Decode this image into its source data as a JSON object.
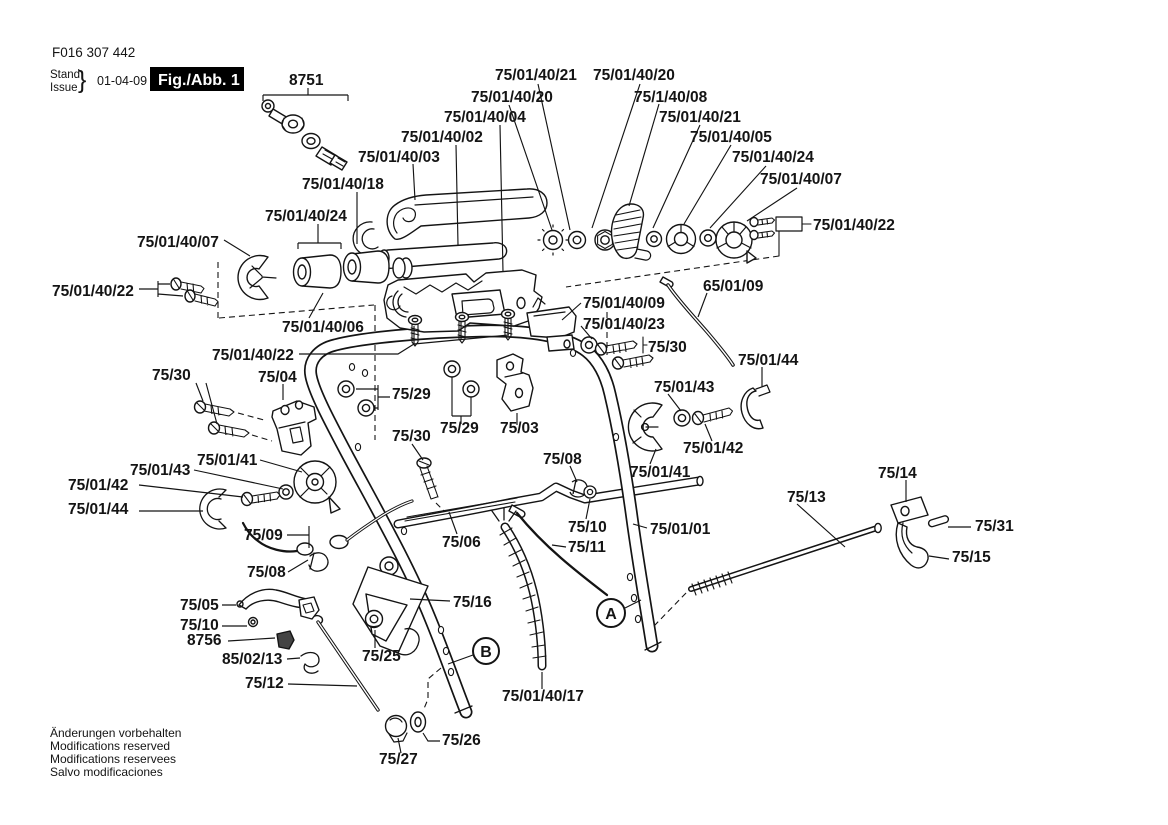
{
  "page": {
    "background": "#ffffff",
    "ink": "#141414"
  },
  "header": {
    "doc_number": "F016 307 442",
    "stand_label": "Stand",
    "issue_label": "Issue",
    "brace": "}",
    "date": "01-04-09",
    "figure_label": "Fig./Abb. 1"
  },
  "callouts": {
    "a": "A",
    "b": "B"
  },
  "footer": {
    "lines": [
      "Änderungen vorbehalten",
      "Modifications reserved",
      "Modifications reservees",
      "Salvo modificaciones"
    ]
  },
  "part_labels": [
    {
      "text": "8751",
      "x": 289,
      "y": 85
    },
    {
      "text": "75/01/40/21",
      "x": 495,
      "y": 80
    },
    {
      "text": "75/01/40/20",
      "x": 593,
      "y": 80
    },
    {
      "text": "75/01/40/20",
      "x": 471,
      "y": 102
    },
    {
      "text": "75/1/40/08",
      "x": 634,
      "y": 102
    },
    {
      "text": "75/01/40/04",
      "x": 444,
      "y": 122
    },
    {
      "text": "75/01/40/21",
      "x": 659,
      "y": 122
    },
    {
      "text": "75/01/40/02",
      "x": 401,
      "y": 142
    },
    {
      "text": "75/01/40/05",
      "x": 690,
      "y": 142
    },
    {
      "text": "75/01/40/03",
      "x": 358,
      "y": 162
    },
    {
      "text": "75/01/40/24",
      "x": 732,
      "y": 162
    },
    {
      "text": "75/01/40/18",
      "x": 302,
      "y": 189
    },
    {
      "text": "75/01/40/07",
      "x": 760,
      "y": 184
    },
    {
      "text": "75/01/40/24",
      "x": 265,
      "y": 221
    },
    {
      "text": "75/01/40/22",
      "x": 813,
      "y": 230
    },
    {
      "text": "75/01/40/07",
      "x": 137,
      "y": 247
    },
    {
      "text": "75/01/40/22",
      "x": 52,
      "y": 296
    },
    {
      "text": "75/01/40/06",
      "x": 282,
      "y": 332
    },
    {
      "text": "75/01/40/22",
      "x": 212,
      "y": 360
    },
    {
      "text": "75/01/40/09",
      "x": 583,
      "y": 308
    },
    {
      "text": "75/01/40/23",
      "x": 583,
      "y": 329
    },
    {
      "text": "65/01/09",
      "x": 703,
      "y": 291
    },
    {
      "text": "75/30",
      "x": 648,
      "y": 352
    },
    {
      "text": "75/01/44",
      "x": 738,
      "y": 365
    },
    {
      "text": "75/30",
      "x": 152,
      "y": 380
    },
    {
      "text": "75/04",
      "x": 258,
      "y": 382
    },
    {
      "text": "75/29",
      "x": 392,
      "y": 399
    },
    {
      "text": "75/01/43",
      "x": 654,
      "y": 392
    },
    {
      "text": "75/29",
      "x": 440,
      "y": 433
    },
    {
      "text": "75/03",
      "x": 500,
      "y": 433
    },
    {
      "text": "75/30",
      "x": 392,
      "y": 441
    },
    {
      "text": "75/01/41",
      "x": 630,
      "y": 477
    },
    {
      "text": "75/01/41",
      "x": 197,
      "y": 465
    },
    {
      "text": "75/01/43",
      "x": 130,
      "y": 475
    },
    {
      "text": "75/01/42",
      "x": 68,
      "y": 490
    },
    {
      "text": "75/01/42",
      "x": 683,
      "y": 453
    },
    {
      "text": "75/01/44",
      "x": 68,
      "y": 514
    },
    {
      "text": "75/08",
      "x": 543,
      "y": 464
    },
    {
      "text": "75/14",
      "x": 878,
      "y": 478
    },
    {
      "text": "75/13",
      "x": 787,
      "y": 502
    },
    {
      "text": "75/10",
      "x": 568,
      "y": 532
    },
    {
      "text": "75/01/01",
      "x": 650,
      "y": 534
    },
    {
      "text": "75/11",
      "x": 568,
      "y": 552
    },
    {
      "text": "75/06",
      "x": 442,
      "y": 547
    },
    {
      "text": "75/09",
      "x": 244,
      "y": 540
    },
    {
      "text": "75/31",
      "x": 975,
      "y": 531
    },
    {
      "text": "75/15",
      "x": 952,
      "y": 562
    },
    {
      "text": "75/08",
      "x": 247,
      "y": 577
    },
    {
      "text": "75/05",
      "x": 180,
      "y": 610
    },
    {
      "text": "75/10",
      "x": 180,
      "y": 630
    },
    {
      "text": "8756",
      "x": 187,
      "y": 645
    },
    {
      "text": "85/02/13",
      "x": 222,
      "y": 664
    },
    {
      "text": "75/25",
      "x": 362,
      "y": 661
    },
    {
      "text": "75/16",
      "x": 453,
      "y": 607
    },
    {
      "text": "75/12",
      "x": 245,
      "y": 688
    },
    {
      "text": "75/01/40/17",
      "x": 502,
      "y": 701
    },
    {
      "text": "75/26",
      "x": 442,
      "y": 745
    },
    {
      "text": "75/27",
      "x": 379,
      "y": 764
    }
  ]
}
